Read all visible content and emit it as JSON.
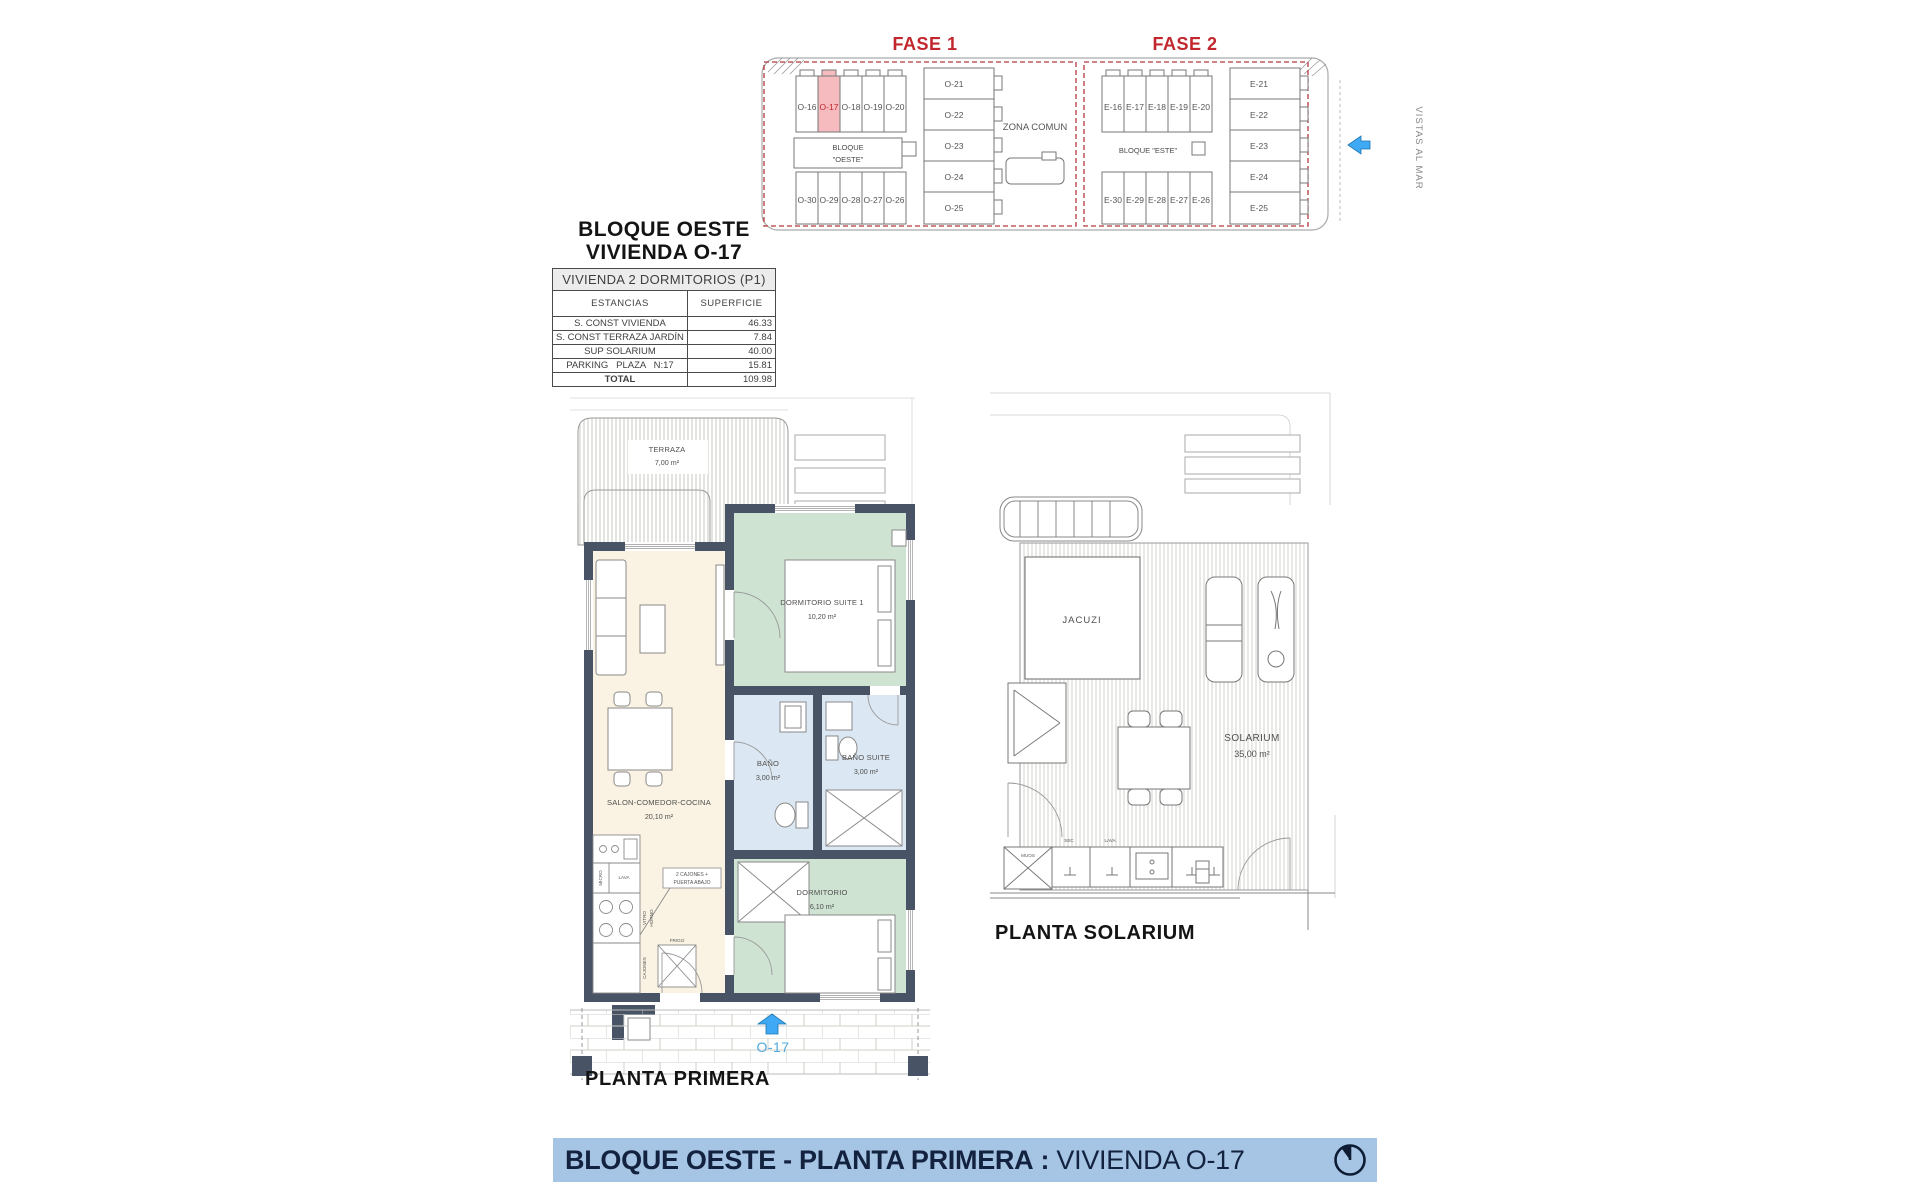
{
  "site_plan": {
    "fase1_label": "FASE 1",
    "fase2_label": "FASE 2",
    "zona_comun": "ZONA COMUN",
    "vistas_al_mar": "VISTAS AL MAR",
    "fase1": {
      "bloque_line1": "BLOQUE",
      "bloque_line2": "\"OESTE\"",
      "top_row": [
        "O-16",
        "O-17",
        "O-18",
        "O-19",
        "O-20"
      ],
      "right_col": [
        "O-21",
        "O-22",
        "O-23",
        "O-24",
        "O-25"
      ],
      "bottom_row": [
        "O-30",
        "O-29",
        "O-28",
        "O-27",
        "O-26"
      ],
      "highlighted_unit": "O-17"
    },
    "fase2": {
      "bloque_label": "BLOQUE \"ESTE\"",
      "top_row": [
        "E-16",
        "E-17",
        "E-18",
        "E-19",
        "E-20"
      ],
      "right_col": [
        "E-21",
        "E-22",
        "E-23",
        "E-24",
        "E-25"
      ],
      "bottom_row": [
        "E-30",
        "E-29",
        "E-28",
        "E-27",
        "E-26"
      ]
    }
  },
  "title_block": {
    "line1": "BLOQUE OESTE",
    "line2": "VIVIENDA O-17"
  },
  "area_table": {
    "header": "VIVIENDA 2 DORMITORIOS (P1)",
    "col_estancias": "ESTANCIAS",
    "col_superficie": "SUPERFICIE",
    "rows": [
      {
        "label": "S. CONST VIVIENDA",
        "value": "46.33"
      },
      {
        "label": "S. CONST TERRAZA JARDÍN",
        "value": "7.84"
      },
      {
        "label": "SUP SOLARIUM",
        "value": "40.00"
      },
      {
        "label": "PARKING   PLAZA   N:17",
        "value": "15.81"
      }
    ],
    "total_label": "TOTAL",
    "total_value": "109.98"
  },
  "floor_plan": {
    "title": "PLANTA PRIMERA",
    "unit_label": "O-17",
    "rooms": {
      "terraza": {
        "name": "TERRAZA",
        "area": "7,00 m²"
      },
      "dormitorio_suite": {
        "name": "DORMITORIO SUITE 1",
        "area": "10,20 m²"
      },
      "salon": {
        "name": "SALON-COMEDOR-COCINA",
        "area": "20,10 m²"
      },
      "bano": {
        "name": "BAÑO",
        "area": "3,00 m²"
      },
      "bano_suite": {
        "name": "BAÑO SUITE",
        "area": "3,00 m²"
      },
      "dormitorio": {
        "name": "DORMITORIO",
        "area": "6,10 m²"
      }
    },
    "kitchen": {
      "micro": "MICRO",
      "lava": "LAVA",
      "vitro": "VITRO",
      "horno": "HORNO",
      "cajones": "CAJONES",
      "frigo": "FRIGO",
      "note_line1": "2 CAJONES +",
      "note_line2": "PUERTA ABAJO"
    }
  },
  "solarium_plan": {
    "title": "PLANTA SOLARIUM",
    "jacuzi": "JACUZI",
    "solarium_name": "SOLARIUM",
    "solarium_area": "35,00 m²",
    "counter": {
      "sec": "SEC",
      "lava": "LAVA",
      "box": "MUOS"
    }
  },
  "footer": {
    "title_bold": "BLOQUE OESTE - PLANTA PRIMERA",
    "separator": " : ",
    "title_regular": "VIVIENDA O-17"
  },
  "colors": {
    "accent_red": "#C1272D",
    "highlight_pink": "#F6BBBE",
    "wall_dark": "#485366",
    "bedroom_green": "#CEE3D2",
    "bath_blue": "#DBE7F2",
    "living_beige": "#FAF3E3",
    "banner_blue": "#A6C5E5",
    "banner_text": "#13233F",
    "arrow_blue": "#3FA9F5"
  }
}
